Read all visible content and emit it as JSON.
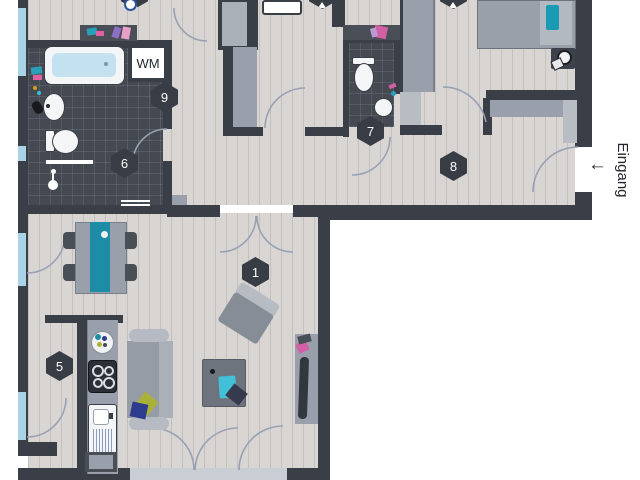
{
  "labels": {
    "washing_machine": "WM",
    "entrance": "Eingang",
    "entrance_arrow": "←"
  },
  "markers": [
    {
      "id": "living-room",
      "number": "1"
    },
    {
      "id": "kitchen",
      "number": "5"
    },
    {
      "id": "bathroom",
      "number": "6"
    },
    {
      "id": "wc",
      "number": "7"
    },
    {
      "id": "hallway",
      "number": "8"
    },
    {
      "id": "utility-niche",
      "number": "9"
    }
  ],
  "partial_markers": [
    {
      "id": "top-room-left"
    },
    {
      "id": "top-room-middle"
    },
    {
      "id": "top-room-right"
    }
  ],
  "colors": {
    "wall": "#3a3e46",
    "floor": "#d8d5d2",
    "tile_floor": "#454a52",
    "window": "#a9d3e6",
    "furniture_gray": "#9aa0ab",
    "furniture_light": "#b8bdc4",
    "accent_teal": "#1d8ca6",
    "water_blue": "#c3e1ef",
    "cyan": "#41c0d8",
    "pink": "#d35fa5",
    "navy": "#2e3c8e",
    "olive": "#a9b138"
  }
}
